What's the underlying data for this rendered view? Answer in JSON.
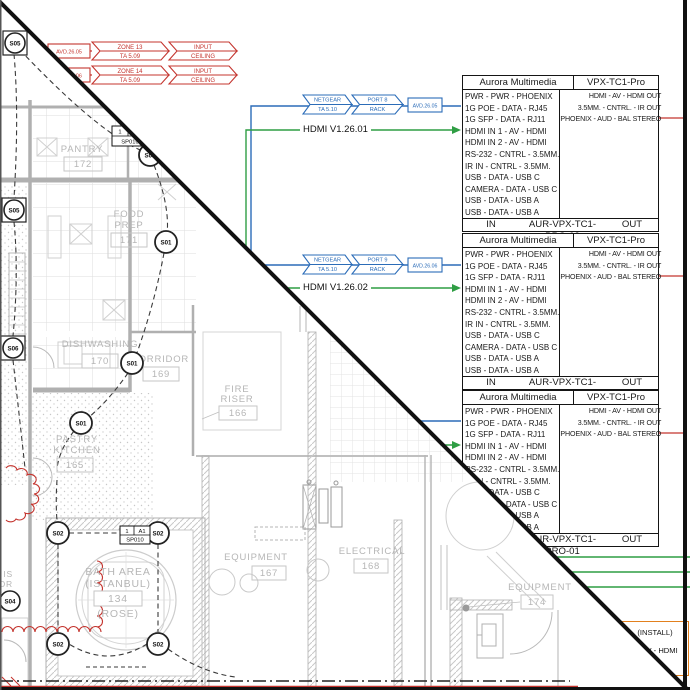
{
  "colors": {
    "red": "#c4342e",
    "blue": "#2b6cb8",
    "green": "#2f9e44",
    "orange": "#e2801e",
    "plan_gray": "#b6b6b6",
    "wall_gray": "#b0b0b0",
    "line_black": "#1a1a1a"
  },
  "zones": [
    {
      "ref": "AVD.26.05",
      "zone": "ZONE 13",
      "ta": "TA 5.09",
      "type": "INPUT",
      "location": "CEILING"
    },
    {
      "ref": "AVD.26.06",
      "zone": "ZONE 14",
      "ta": "TA 5.09",
      "type": "INPUT",
      "location": "CEILING"
    }
  ],
  "runs": [
    {
      "switch": "NETGEAR",
      "switch_id": "TA 5.10",
      "port": "PORT 8",
      "port_loc": "RACK",
      "ref": "AVD.26.05",
      "hdmi": "HDMI V1.26.01"
    },
    {
      "switch": "NETGEAR",
      "switch_id": "TA 5.10",
      "port": "PORT 9",
      "port_loc": "RACK",
      "ref": "AVD.26.06",
      "hdmi": "HDMI V1.26.02"
    }
  ],
  "io": {
    "maker": "Aurora Multimedia",
    "model": "VPX-TC1-Pro",
    "inputs": [
      "PWR - PWR - PHOENIX",
      "1G POE - DATA - RJ45",
      "1G SFP - DATA - RJ11",
      "HDMI IN 1 - AV - HDMI",
      "HDMI IN 2 - AV - HDMI",
      "RS-232 - CNTRL - 3.5MM.",
      "IR IN - CNTRL - 3.5MM.",
      "USB - DATA - USB C",
      "CAMERA - DATA - USB C",
      "USB - DATA - USB A",
      "USB - DATA - USB A"
    ],
    "outputs": [
      "HDMI - AV - HDMI OUT",
      "3.5MM. - CNTRL. - IR OUT",
      "PHOENIX - AUD - BAL STEREO"
    ],
    "in_label": "IN",
    "out_label": "OUT",
    "devices": [
      "AUR-VPX-TC1-PRO-03",
      "AUR-VPX-TC1-PRO-02",
      "AUR-VPX-TC1-PRO-01"
    ]
  },
  "install": {
    "line1": "(INSTALL)",
    "line2": "AV - HDMI"
  },
  "plan": {
    "rooms": {
      "pantry": {
        "name": "PANTRY",
        "number": "172"
      },
      "food_prep": {
        "name": "FOOD",
        "name2": "PREP",
        "number": "171"
      },
      "dishwashing": {
        "name": "DISHWASHING",
        "number": "170"
      },
      "corridor": {
        "name": "CORRIDOR",
        "number": "169"
      },
      "fire_riser": {
        "name": "FIRE",
        "name2": "RISER",
        "number": "166"
      },
      "pastry": {
        "name": "PASTRY",
        "name2": "KITCHEN",
        "number": "165"
      },
      "bath": {
        "name": "BATH AREA",
        "name2": "(ISTANBUL)",
        "number": "134",
        "name3": "(ROSE)"
      },
      "equipment167": {
        "name": "EQUIPMENT",
        "number": "167"
      },
      "electrical": {
        "name": "ELECTRICAL",
        "number": "168"
      },
      "equipment174": {
        "name": "EQUIPMENT",
        "number": "174"
      }
    },
    "tags": {
      "s01": "S01",
      "s02": "S02",
      "s04": "S04",
      "s05": "S05",
      "s06": "S06"
    },
    "sp_tag": {
      "c1": "1",
      "c2": "A1",
      "id": "SP010"
    },
    "edge_label": {
      "line1": "IS",
      "line2": "OR"
    }
  }
}
